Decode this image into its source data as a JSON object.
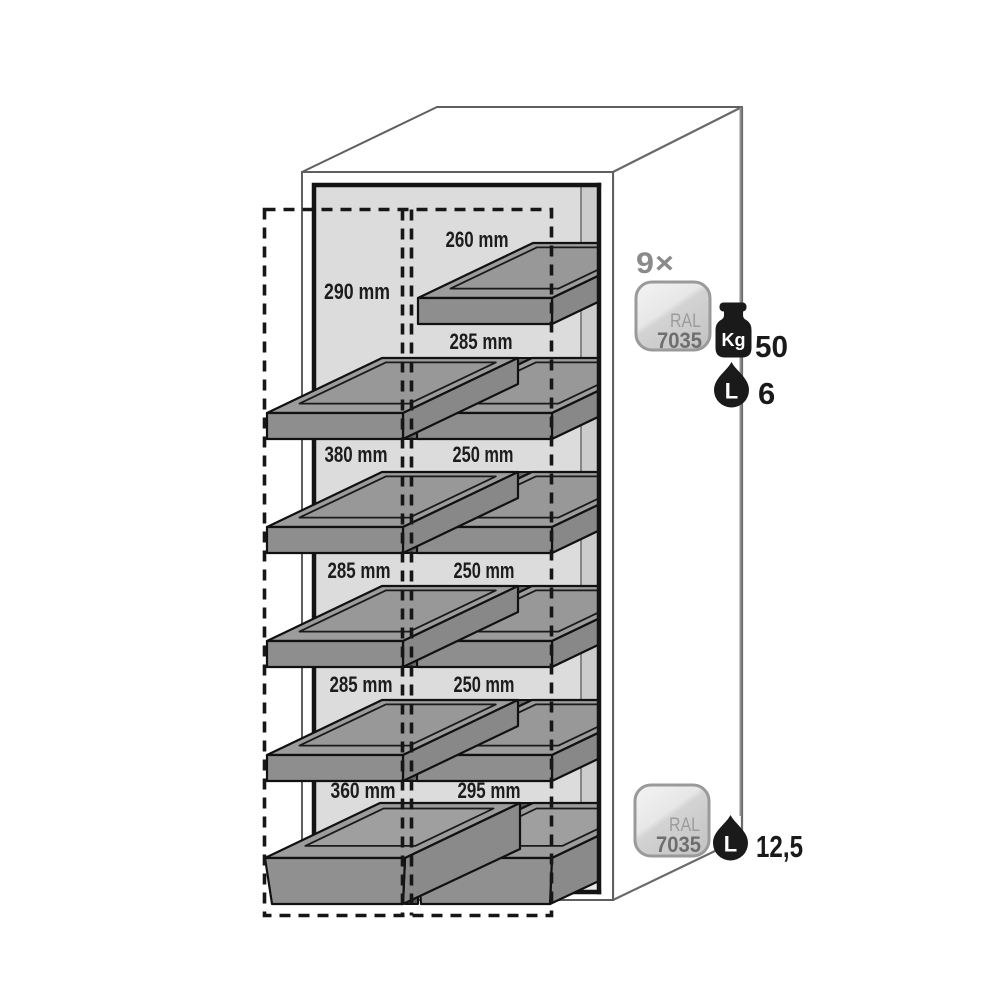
{
  "diagram_labels": {
    "rows": [
      {
        "left": "290 mm",
        "right": "260 mm"
      },
      {
        "right": "285 mm"
      },
      {
        "left": "380 mm",
        "right": "250 mm"
      },
      {
        "left": "285 mm",
        "right": "250 mm"
      },
      {
        "left": "285 mm",
        "right": "250 mm"
      },
      {
        "left": "360 mm",
        "right": "295 mm"
      }
    ]
  },
  "annotations": {
    "quantity": "9×",
    "shelf_badge": {
      "standard": "RAL",
      "code": "7035"
    },
    "load_capacity": {
      "unit": "Kg",
      "value": "50"
    },
    "shelf_volume": {
      "unit": "L",
      "value": "6"
    },
    "sump_badge": {
      "standard": "RAL",
      "code": "7035"
    },
    "sump_volume": {
      "unit": "L",
      "value": "12,5"
    }
  },
  "colors": {
    "ral_7035_swatch": "#d2d2d2",
    "tray_gray": "#9c9c9c",
    "interior_panel": "#dcdcdc",
    "icon_black": "#1a1a1a",
    "quantity_gray": "#8a8a8a"
  }
}
